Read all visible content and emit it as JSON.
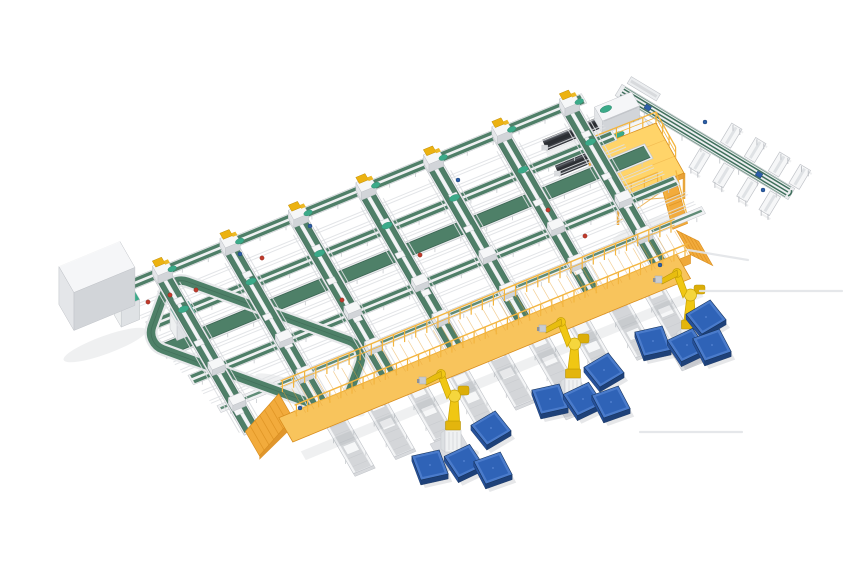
{
  "meta": {
    "title": "Isometric 3D render of an automated parcel sorting and robotic palletizing system",
    "width": 860,
    "height": 580,
    "background": "#ffffff"
  },
  "colors": {
    "background": "#ffffff",
    "belt_green": "#4f7f68",
    "belt_green_dark": "#3a6452",
    "band_green": "#4e8068",
    "teal": "#3baa89",
    "teal_dark": "#2d8a6e",
    "frame_light": "#eceef0",
    "frame_mid": "#d8dadd",
    "frame_stroke": "#c0c3c8",
    "roller_gray": "#d4d6d9",
    "white": "#f6f7f8",
    "walkway_top": "#f8c45c",
    "walkway_side": "#efa93a",
    "walkway_rail": "#f3b53f",
    "walkway_dark": "#d98e1e",
    "ramp_fill": "#f2ab3c",
    "mezz_top": "#ffd469",
    "mezz_frame": "#e8a63c",
    "robot_yellow": "#f0c713",
    "robot_yellow_dark": "#c9a202",
    "robot_yellow_deep": "#b8930a",
    "robot_light": "#f5d63d",
    "pedestal": "#eff1f2",
    "pallet_top": "#2f63b7",
    "pallet_rim": "#4a7bcb",
    "pallet_side": "#1e4179",
    "pallet_front": "#26519a",
    "pallet_edge": "#16345f",
    "loader_dark": "#3e4147",
    "loader_darker": "#2b2e33",
    "box_top": "#f5f6f8",
    "box_left": "#e4e6e9",
    "box_right": "#d2d5d9",
    "dot_red": "#c03a2b",
    "dot_blue": "#2d5fa7",
    "gold": "#ecb211",
    "gold_dark": "#c08e07",
    "shadow": "rgba(100,108,120,0.16)",
    "shadow_soft": "rgba(100,108,120,0.10)"
  },
  "axes": {
    "u": [
      0.925,
      -0.38
    ],
    "v": [
      0.5,
      0.866
    ],
    "origin": [
      62,
      300
    ]
  },
  "cross_lines": [
    {
      "name": "infeed-line",
      "y": 12,
      "x0": 55,
      "x1": 558,
      "style": "double"
    },
    {
      "name": "collector-line-2",
      "y": 58,
      "x0": 62,
      "x1": 566,
      "style": "double"
    },
    {
      "name": "main-collector-belt",
      "y": 86,
      "x0": 62,
      "x1": 588,
      "style": "wide"
    },
    {
      "name": "collector-line-3",
      "y": 124,
      "x0": 72,
      "x1": 598,
      "style": "double"
    },
    {
      "name": "lane-end-line",
      "y": 162,
      "x0": 82,
      "x1": 606,
      "style": "thin"
    }
  ],
  "support_rails": [
    {
      "y": 34,
      "x0": 58,
      "x1": 560
    },
    {
      "y": 46,
      "x0": 60,
      "x1": 562
    },
    {
      "y": 72,
      "x0": 62,
      "x1": 570
    },
    {
      "y": 102,
      "x0": 66,
      "x1": 584
    },
    {
      "y": 112,
      "x0": 68,
      "x1": 590
    },
    {
      "y": 140,
      "x0": 76,
      "x1": 600
    },
    {
      "y": 152,
      "x0": 78,
      "x1": 602
    }
  ],
  "lanes": {
    "x": [
      100,
      173,
      247,
      320,
      393,
      467,
      540
    ],
    "y0": 14,
    "y1": 196,
    "carriage_t": [
      0.2,
      0.42,
      0.63,
      0.84
    ],
    "side_rail_offset": 12
  },
  "junction_rows": [
    124,
    165
  ],
  "pick_lanes": {
    "x": [
      178,
      222,
      265,
      309,
      352,
      396,
      440,
      483,
      522
    ],
    "y0": 198,
    "y1": 274,
    "item_t": [
      0.3,
      0.62
    ]
  },
  "walkway": {
    "x0": 130,
    "x1": 560,
    "y": 207,
    "half_width": 14,
    "lift": 24,
    "post_step": 12,
    "leg_step": 40,
    "ramp_len": 36
  },
  "robots": [
    {
      "x": 453,
      "y": 452
    },
    {
      "x": 573,
      "y": 400
    },
    {
      "x": 689,
      "y": 351
    }
  ],
  "pallets": [
    {
      "x": 491,
      "y": 433,
      "rot": -8
    },
    {
      "x": 430,
      "y": 470,
      "rot": 10
    },
    {
      "x": 464,
      "y": 466,
      "rot": -3
    },
    {
      "x": 493,
      "y": 473,
      "rot": 3
    },
    {
      "x": 604,
      "y": 375,
      "rot": -8
    },
    {
      "x": 550,
      "y": 404,
      "rot": 10
    },
    {
      "x": 583,
      "y": 404,
      "rot": -3
    },
    {
      "x": 611,
      "y": 407,
      "rot": 3
    },
    {
      "x": 706,
      "y": 322,
      "rot": -8
    },
    {
      "x": 653,
      "y": 346,
      "rot": 10
    },
    {
      "x": 687,
      "y": 350,
      "rot": -3
    },
    {
      "x": 712,
      "y": 350,
      "rot": 3
    }
  ],
  "mezzanine": {
    "cx": 637,
    "cy": 187,
    "a": [
      33,
      -13
    ],
    "b": [
      14,
      25
    ],
    "lift": 26
  },
  "loaders": [
    {
      "x": 574,
      "y": 48
    },
    {
      "x": 572,
      "y": 77
    }
  ],
  "loader_line": {
    "x": 592,
    "y0": 24,
    "y1": 88
  },
  "branch": {
    "p0": [
      622,
      92
    ],
    "p1": [
      788,
      192
    ],
    "chute_offset": 23,
    "chutes_lower": [
      102,
      130,
      158,
      184
    ],
    "chutes_upper": [
      116,
      144,
      172,
      196
    ],
    "stubs": [
      {
        "t0": 2,
        "t1": 46,
        "o": 15
      },
      {
        "t0": 0,
        "t1": 34,
        "o": -14
      }
    ],
    "motors": [
      30,
      160
    ]
  },
  "infeed_box": {
    "x": 28,
    "y": 18,
    "hu": 33,
    "hv": 15,
    "h": 38
  },
  "loop": {
    "cx": 256,
    "cy": 345,
    "rot": 20,
    "rx": 104,
    "ry": 36
  },
  "cabinets": [
    {
      "x": 48,
      "y": 41
    },
    {
      "x": 90,
      "y": 75
    }
  ],
  "dots": {
    "red": [
      [
        148,
        302
      ],
      [
        170,
        295
      ],
      [
        196,
        290
      ],
      [
        262,
        258
      ],
      [
        342,
        300
      ],
      [
        420,
        255
      ],
      [
        548,
        210
      ],
      [
        585,
        236
      ]
    ],
    "blue": [
      [
        240,
        254
      ],
      [
        310,
        226
      ],
      [
        458,
        180
      ],
      [
        705,
        122
      ],
      [
        763,
        190
      ],
      [
        300,
        408
      ],
      [
        660,
        265
      ]
    ]
  },
  "shadow_lines": [
    [
      700,
      291,
      842,
      291
    ],
    [
      640,
      432,
      742,
      432
    ],
    [
      688,
      250,
      748,
      260
    ]
  ]
}
